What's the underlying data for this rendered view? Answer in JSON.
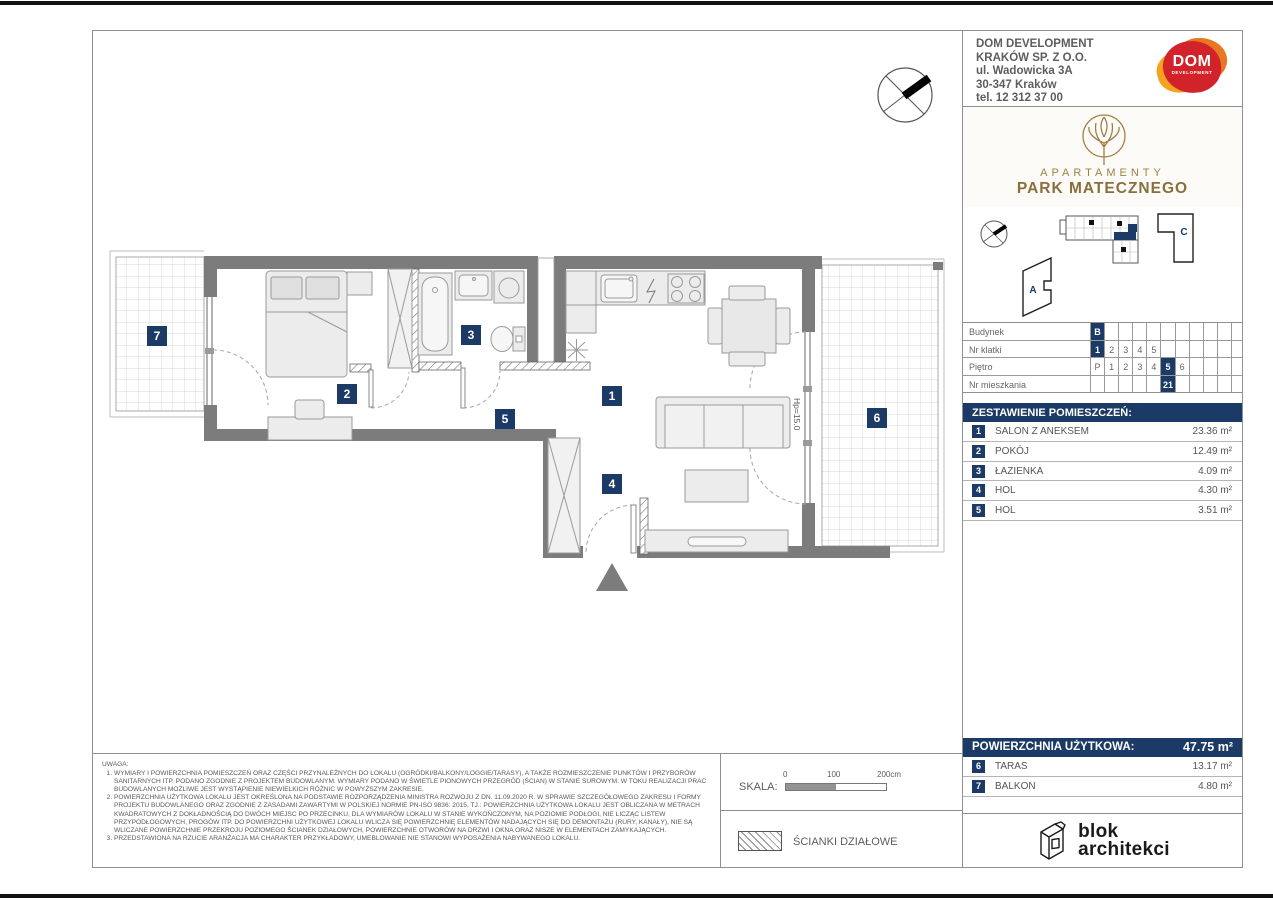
{
  "company": {
    "name1": "DOM DEVELOPMENT",
    "name2": "KRAKÓW SP. Z O.O.",
    "address1": "ul. Wadowicka 3A",
    "address2": "30-347 Kraków",
    "phone": "tel. 12 312 37 00",
    "logo_text": "DOM",
    "logo_sub": "DEVELOPMENT"
  },
  "brand": {
    "top": "APARTAMENTY",
    "name": "PARK MATECZNEGO"
  },
  "site": {
    "building_a": "A",
    "building_c": "C"
  },
  "location_table": {
    "rows": [
      {
        "label": "Budynek",
        "cells": [
          "B",
          "",
          "",
          "",
          "",
          "",
          "",
          "",
          "",
          ""
        ]
      },
      {
        "label": "Nr klatki",
        "cells": [
          "1",
          "2",
          "3",
          "4",
          "5",
          "",
          "",
          "",
          "",
          ""
        ]
      },
      {
        "label": "Piętro",
        "cells": [
          "P",
          "1",
          "2",
          "3",
          "4",
          "5",
          "6",
          "",
          "",
          ""
        ]
      },
      {
        "label": "Nr mieszkania",
        "cells": [
          "",
          "",
          "",
          "",
          "",
          "21",
          "",
          "",
          "",
          ""
        ]
      }
    ]
  },
  "rooms": {
    "header": "ZESTAWIENIE POMIESZCZEŃ:",
    "items": [
      {
        "no": "1",
        "name": "SALON Z ANEKSEM",
        "area": "23.36 m²"
      },
      {
        "no": "2",
        "name": "POKÓJ",
        "area": "12.49 m²"
      },
      {
        "no": "3",
        "name": "ŁAZIENKA",
        "area": "4.09 m²"
      },
      {
        "no": "4",
        "name": "HOL",
        "area": "4.30 m²"
      },
      {
        "no": "5",
        "name": "HOL",
        "area": "3.51 m²"
      }
    ]
  },
  "total": {
    "label": "POWIERZCHNIA UŻYTKOWA:",
    "value": "47.75 m²"
  },
  "outdoor": {
    "items": [
      {
        "no": "6",
        "name": "TARAS",
        "area": "13.17 m²"
      },
      {
        "no": "7",
        "name": "BALKON",
        "area": "4.80 m²"
      }
    ]
  },
  "plan": {
    "labels": {
      "l1": "1",
      "l2": "2",
      "l3": "3",
      "l4": "4",
      "l5": "5",
      "l6": "6",
      "l7": "7"
    },
    "hp_note": "Hp=15.0"
  },
  "notes": {
    "title": "UWAGA:",
    "items": [
      "WYMIARY I POWIERZCHNIA POMIESZCZEŃ ORAZ CZĘŚCI PRZYNALEŻNYCH DO LOKALU (OGRÓDKI/BALKONY/LOGGIE/TARASY), A TAKŻE ROZMIESZCZENIE PUNKTÓW I PRZYBORÓW SANITARNYCH ITP. PODANO ZGODNIE Z PROJEKTEM BUDOWLANYM. WYMIARY PODANO W ŚWIETLE PIONOWYCH PRZEGRÓD (ŚCIAN) W STANIE SUROWYM. W TOKU REALIZACJI PRAC BUDOWLANYCH MOŻLIWE JEST WYSTĄPIENIE NIEWIELKICH RÓŻNIC W POWYŻSZYM ZAKRESIE.",
      "POWIERZCHNIA UŻYTKOWA LOKALU JEST OKREŚLONA NA PODSTAWIE ROZPORZĄDZENIA MINISTRA ROZWOJU Z DN. 11.09.2020 R. W SPRAWIE SZCZEGÓŁOWEGO ZAKRESU I FORMY PROJEKTU BUDOWLANEGO ORAZ ZGODNIE Z ZASADAMI ZAWARTYMI W POLSKIEJ NORMIE PN-ISO 9836: 2015, TJ.: POWIERZCHNIA UŻYTKOWA LOKALU JEST OBLICZANA W METRACH KWADRATOWYCH Z DOKŁADNOŚCIĄ DO DWÓCH MIEJSC PO PRZECINKU, DLA WYMIARÓW LOKALU W STANIE WYKOŃCZONYM, NA POZIOMIE PODŁOGI, NIE LICZĄC LISTEW PRZYPODŁOGOWYCH, PROGÓW ITP. DO POWIERZCHNI UŻYTKOWEJ LOKALU WLICZA SIĘ POWIERZCHNIĘ ELEMENTÓW NADAJĄCYCH SIĘ DO DEMONTAŻU (RURY, KANAŁY), NIE SĄ WLICZANE POWIERZCHNIE PRZEKROJU POZIOMEGO ŚCIANEK DZIAŁOWYCH, POWIERZCHNIE OTWORÓW NA DRZWI I OKNA ORAZ NISZE W ELEMENTACH ZAMYKAJĄCYCH.",
      "PRZEDSTAWIONA NA RZUCIE ARANŻACJA MA CHARAKTER PRZYKŁADOWY, UMEBLOWANIE NIE STANOWI WYPOSAŻENIA NABYWANEGO LOKALU."
    ]
  },
  "scale": {
    "label": "SKALA:",
    "tick0": "0",
    "tick1": "100",
    "tick2": "200cm"
  },
  "legend": {
    "partition": "ŚCIANKI DZIAŁOWE"
  },
  "architect": {
    "line1": "blok",
    "line2": "architekci"
  },
  "colors": {
    "navy": "#1b3a66",
    "wall": "#7c7c7c",
    "gold": "#a08048",
    "red": "#d2232a",
    "orange": "#e87722"
  }
}
